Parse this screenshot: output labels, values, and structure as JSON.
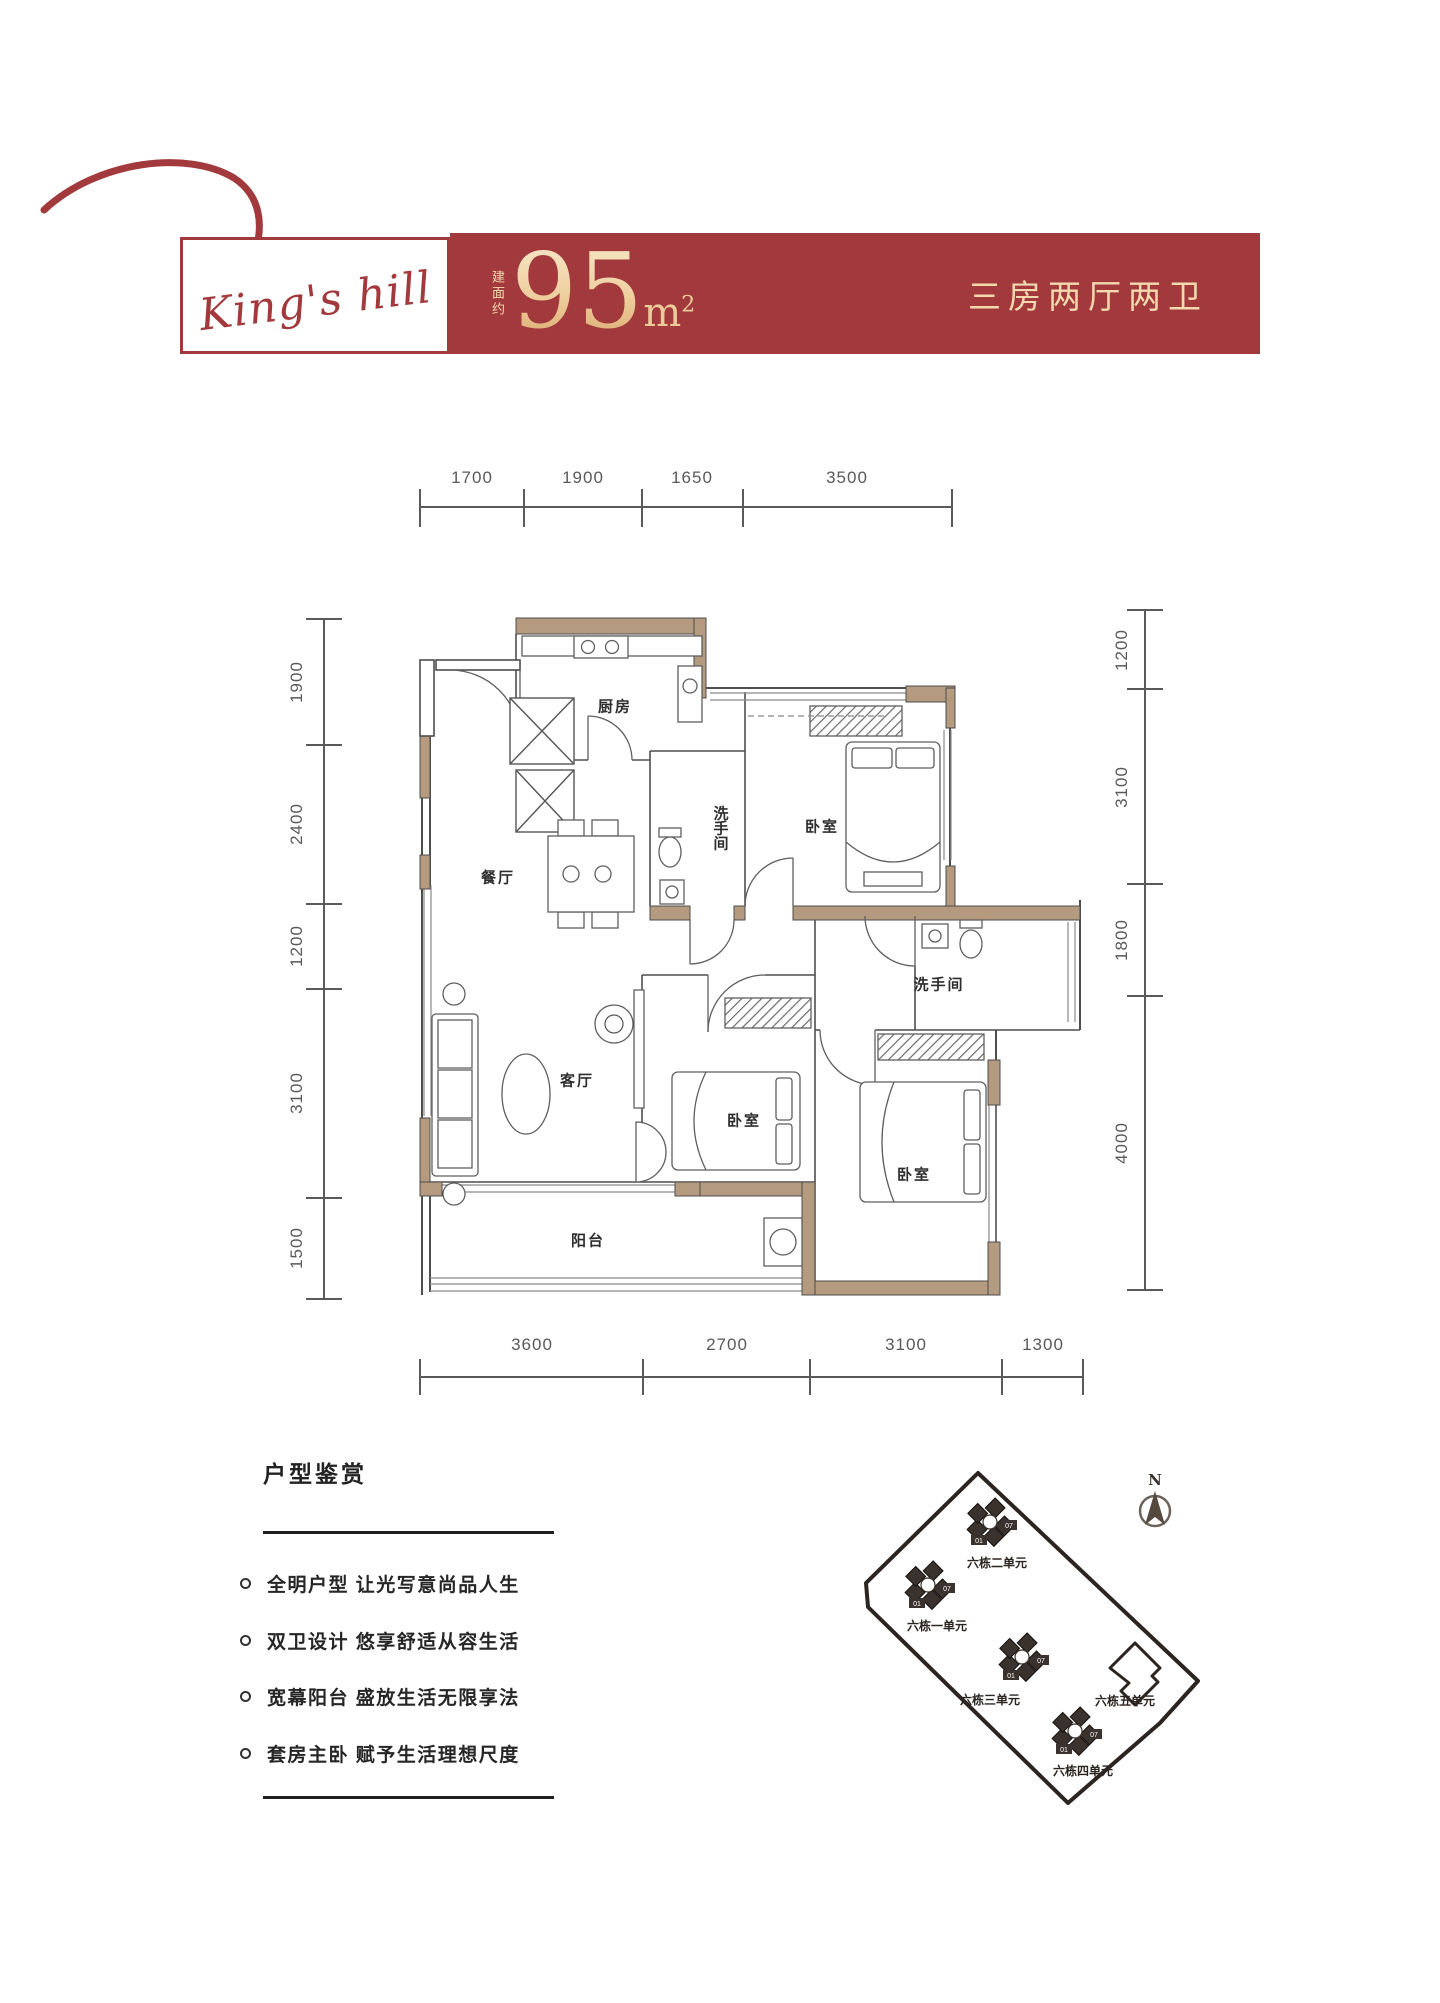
{
  "header": {
    "logo_text": "King's hill",
    "area_prefix": "建面约",
    "area_value": "95",
    "area_unit_base": "m",
    "area_unit_sup": "2",
    "layout_type": "三房两厅两卫",
    "banner_red": "#a23a3d",
    "cream": "#f2d9ae"
  },
  "floor_plan": {
    "dims_top": [
      "1700",
      "1900",
      "1650",
      "3500"
    ],
    "dims_left": [
      "1900",
      "2400",
      "1200",
      "3100",
      "1500"
    ],
    "dims_right": [
      "1200",
      "3100",
      "1800",
      "4000"
    ],
    "dims_bottom": [
      "3600",
      "2700",
      "3100",
      "1300"
    ],
    "rooms": {
      "kitchen": "厨房",
      "dining": "餐厅",
      "bath1": "洗手间",
      "bedroom1": "卧室",
      "bath2": "洗手间",
      "living": "客厅",
      "bedroom2": "卧室",
      "bedroom3": "卧室",
      "balcony": "阳台"
    },
    "wall_color": "#b49a7e",
    "line_color": "#4e4e4e"
  },
  "features": {
    "title": "户型鉴赏",
    "items": [
      "全明户型 让光写意尚品人生",
      "双卫设计 悠享舒适从容生活",
      "宽幕阳台 盛放生活无限享法",
      "套房主卧 赋予生活理想尺度"
    ]
  },
  "site_plan": {
    "north_label": "N",
    "unit_tag_primary": "01",
    "unit_tag_secondary": "07",
    "dark": "#3a322c",
    "buildings": [
      {
        "label": "六栋二单元",
        "x": 150,
        "y": 97,
        "label_x": 157,
        "label_y": 142
      },
      {
        "label": "六栋一单元",
        "x": 88,
        "y": 160,
        "label_x": 97,
        "label_y": 205
      },
      {
        "label": "六栋三单元",
        "x": 182,
        "y": 232,
        "label_x": 150,
        "label_y": 279
      },
      {
        "label": "六栋四单元",
        "x": 235,
        "y": 306,
        "label_x": 243,
        "label_y": 350
      }
    ],
    "building5": {
      "label": "六栋五单元",
      "x": 295,
      "y": 243,
      "label_x": 285,
      "label_y": 280
    }
  }
}
